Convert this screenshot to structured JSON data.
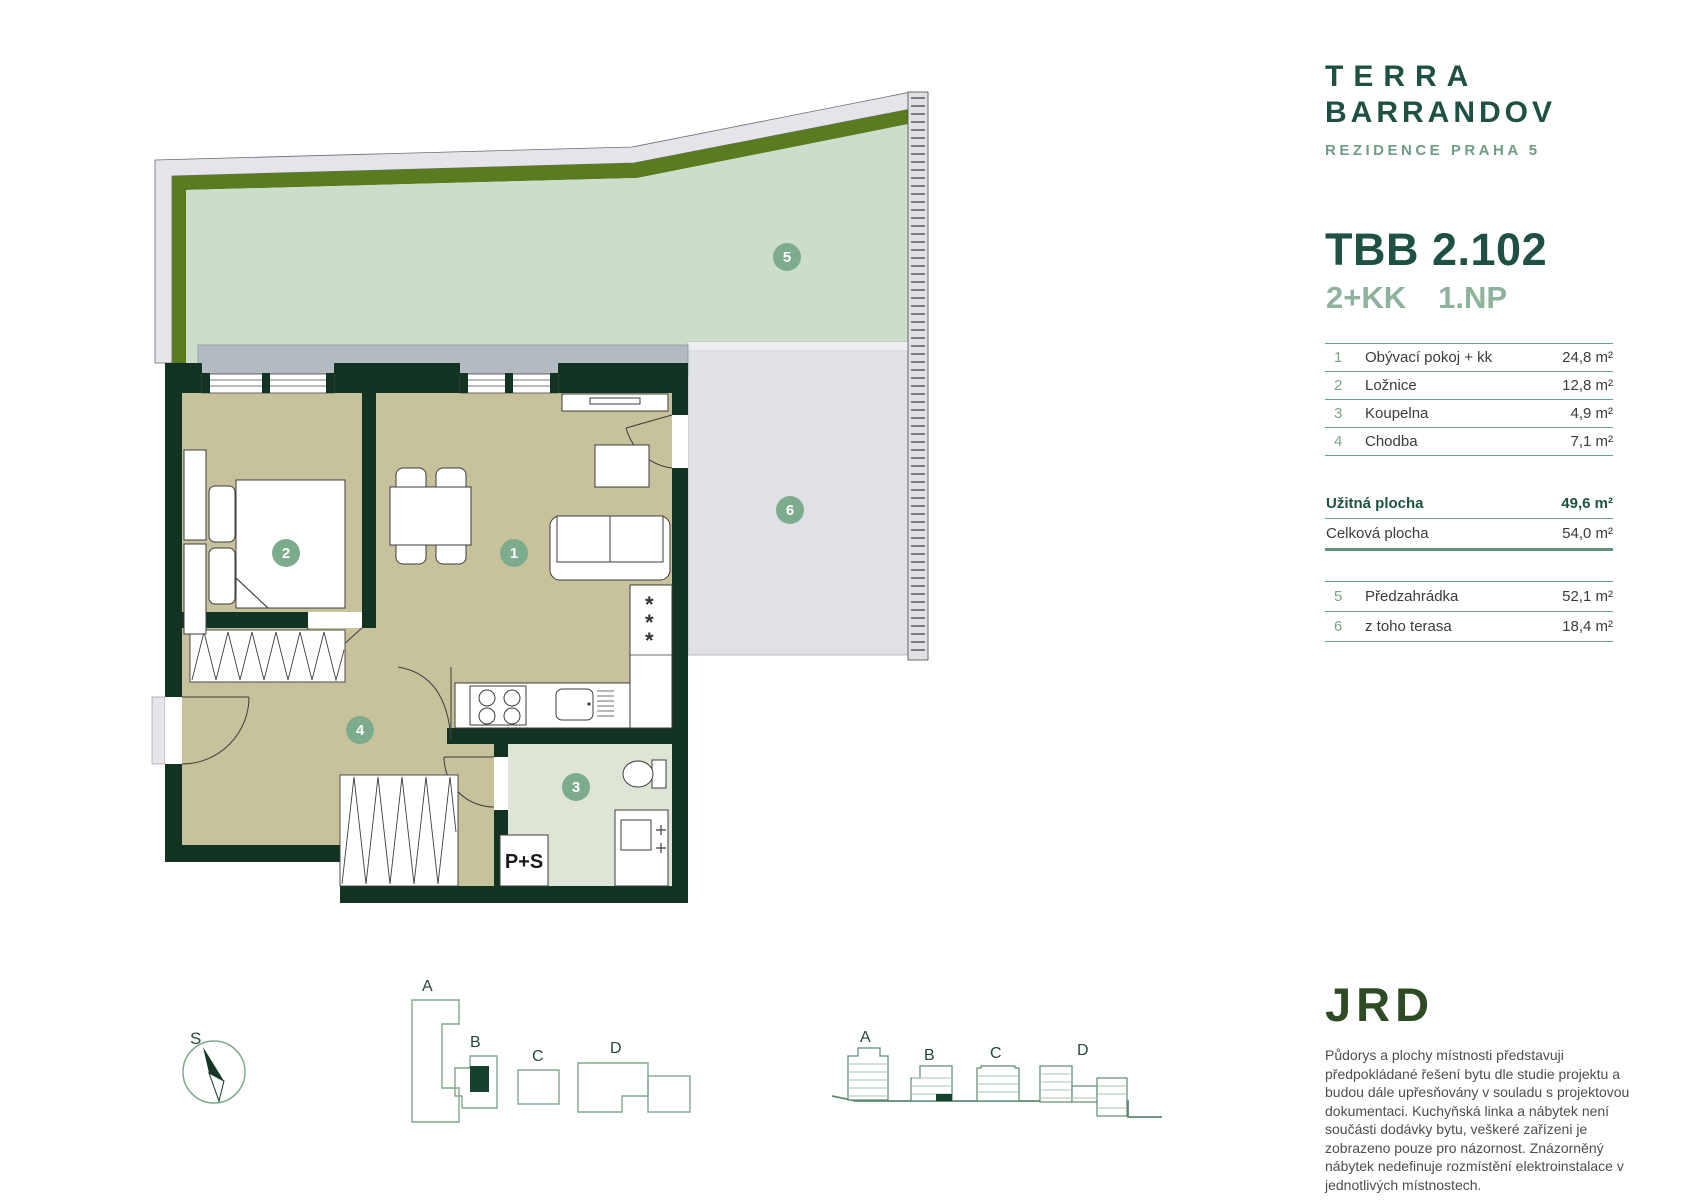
{
  "brand": {
    "line1": "TERRA",
    "line2": "BARRANDOV",
    "subtitle": "REZIDENCE PRAHA 5"
  },
  "unit": {
    "code": "TBB 2.102",
    "layout": "2+KK",
    "floor": "1.NP"
  },
  "rooms": [
    {
      "num": "1",
      "name": "Obývací pokoj + kk",
      "area": "24,8 m²"
    },
    {
      "num": "2",
      "name": "Ložnice",
      "area": "12,8 m²"
    },
    {
      "num": "3",
      "name": "Koupelna",
      "area": "4,9 m²"
    },
    {
      "num": "4",
      "name": "Chodba",
      "area": "7,1 m²"
    }
  ],
  "totals": [
    {
      "name": "Užitná plocha",
      "area": "49,6 m²"
    },
    {
      "name": "Celková plocha",
      "area": "54,0 m²"
    }
  ],
  "outdoor": [
    {
      "num": "5",
      "name": "Předzahrádka",
      "area": "52,1 m²"
    },
    {
      "num": "6",
      "name": "z toho terasa",
      "area": "18,4 m²"
    }
  ],
  "plan": {
    "labels": {
      "living": "1",
      "bedroom": "2",
      "bathroom": "3",
      "hall": "4",
      "garden": "5",
      "terrace": "6"
    },
    "ps_label": "P+S",
    "fridge_stars": "*  *  *",
    "compass": "S"
  },
  "siteplan": {
    "labels": [
      "A",
      "B",
      "C",
      "D"
    ]
  },
  "elevations": {
    "labels": [
      "A",
      "B",
      "C",
      "D"
    ]
  },
  "logo_text": "JRD",
  "disclaimer": "Půdorys a plochy místnosti představuji předpokládané řešení bytu dle studie projektu a budou dále upřesňovány v souladu s projektovou dokumentaci. Kuchyňská linka a nábytek není součásti dodávky bytu, veškeré zařízeni je zobrazeno pouze pro názornost. Znázorněný nábytek nedefinuje rozmístění elektroinstalace v jednotlivých místnostech.",
  "colors": {
    "brand_green": "#1e5143",
    "sage": "#7ba68b",
    "wall": "#123322",
    "floor": "#c6c29b",
    "garden": "#ccdecb",
    "olive": "#5a7b1f"
  }
}
